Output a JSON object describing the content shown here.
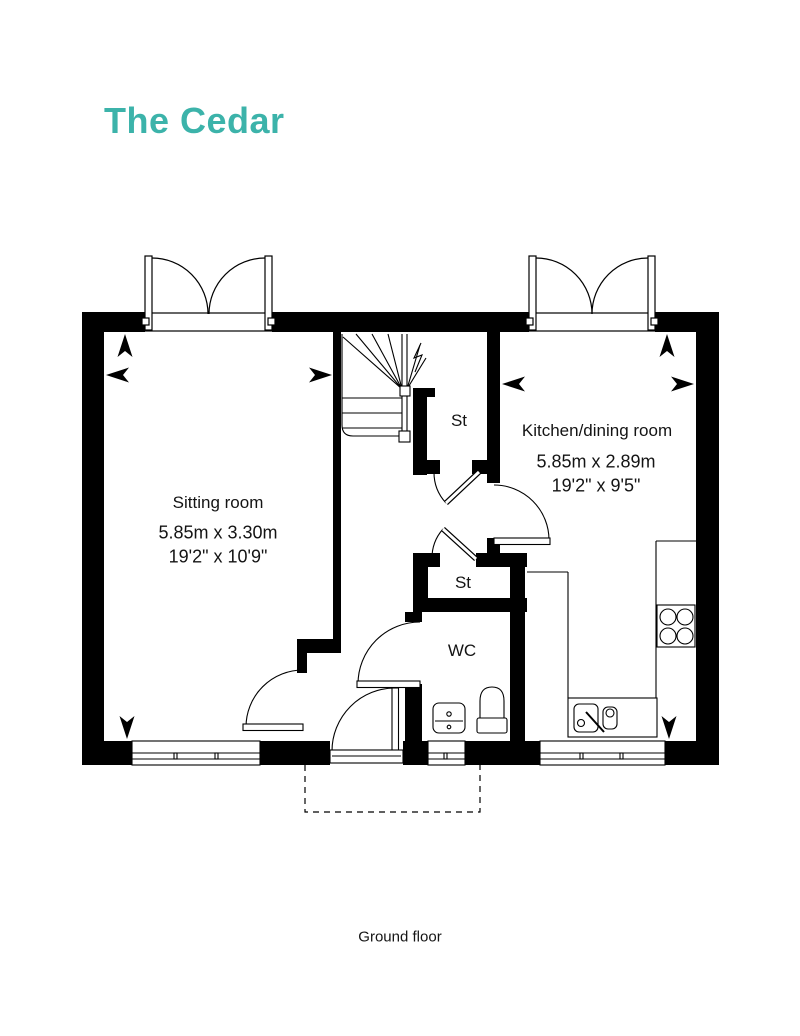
{
  "title": "The Cedar",
  "floor_label": "Ground floor",
  "colors": {
    "accent": "#3cb3aa",
    "line": "#000000"
  },
  "rooms": {
    "sitting_room": {
      "name": "Sitting room",
      "size_metric": "5.85m x 3.30m",
      "size_imperial": "19'2\" x 10'9\""
    },
    "kitchen_dining": {
      "name": "Kitchen/dining room",
      "size_metric": "5.85m x 2.89m",
      "size_imperial": "19'2\" x 9'5\""
    },
    "storage_top": {
      "name": "St"
    },
    "storage_bottom": {
      "name": "St"
    },
    "wc": {
      "name": "WC"
    }
  }
}
